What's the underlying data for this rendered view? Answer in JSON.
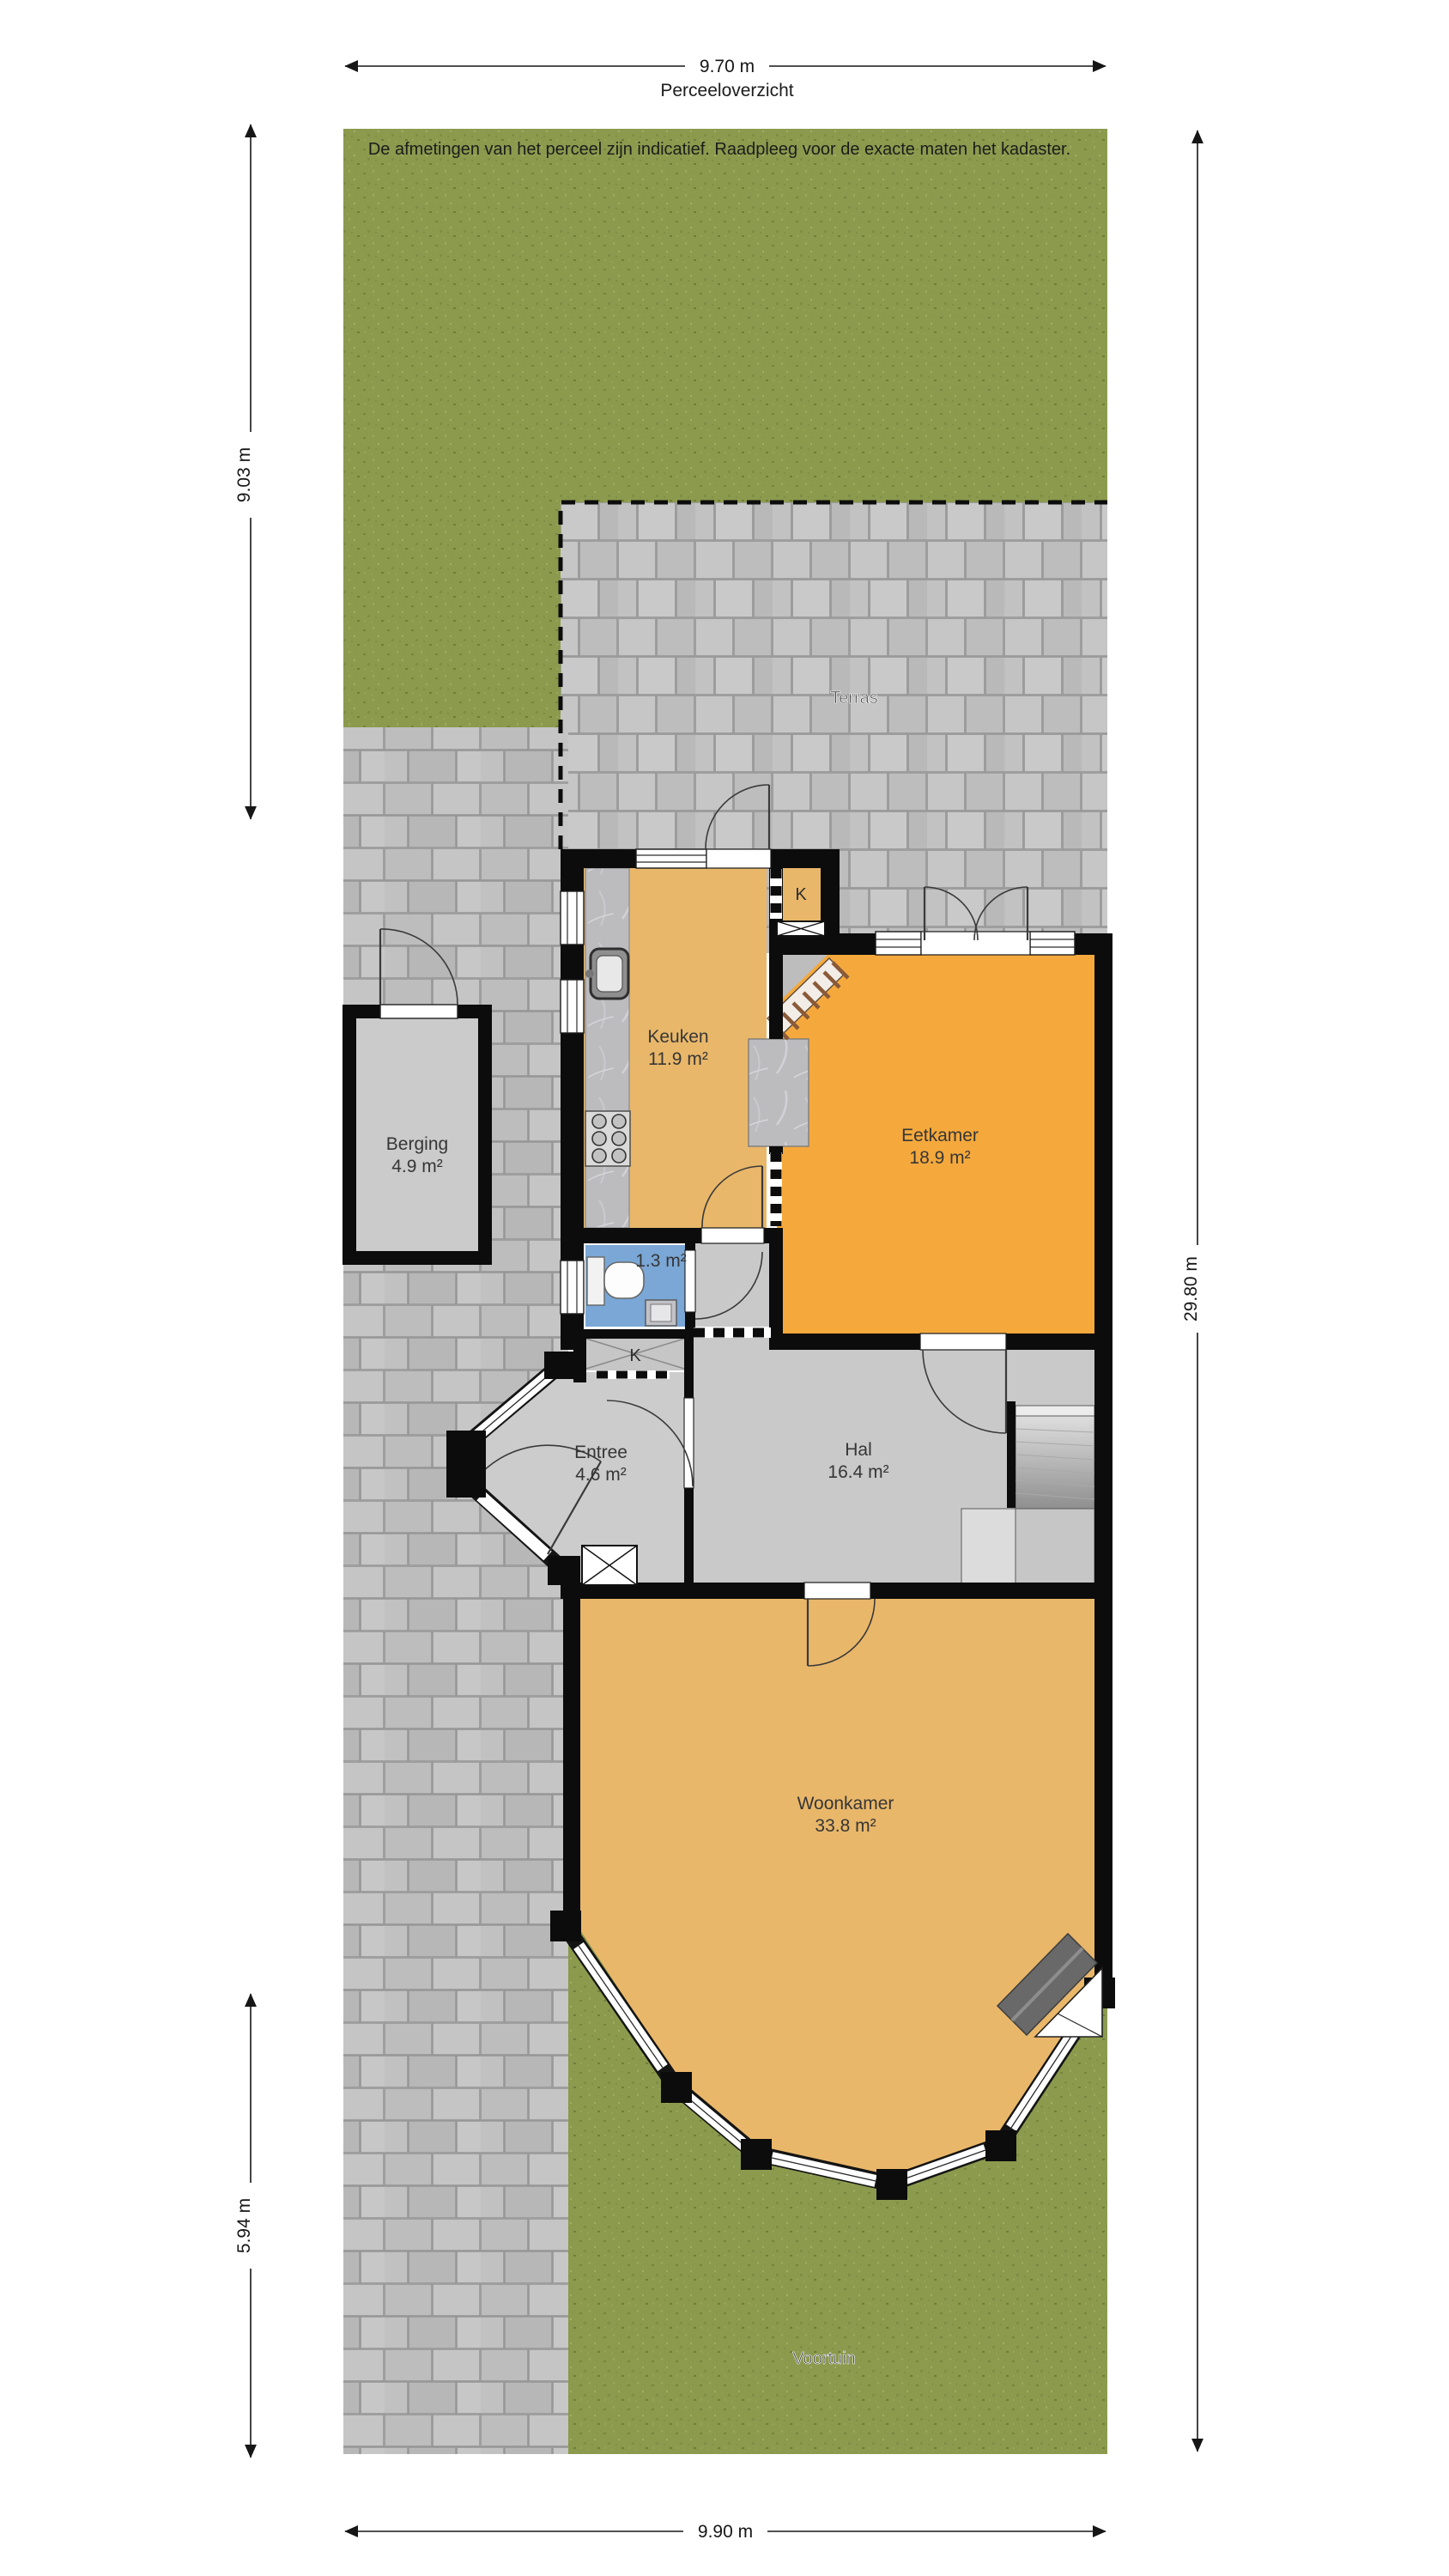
{
  "page": {
    "title": "Perceeloverzicht",
    "disclaimer": "De afmetingen van het perceel zijn indicatief. Raadpleeg voor de exacte maten het kadaster."
  },
  "dimensions": {
    "top": "9.70 m",
    "left_upper": "9.03 m",
    "left_lower": "5.94 m",
    "right": "29.80 m",
    "bottom": "9.90 m"
  },
  "site": {
    "terrace_label": "Terras",
    "front_garden_label": "Voortuin"
  },
  "rooms": {
    "berging": {
      "name": "Berging",
      "area": "4.9 m²"
    },
    "keuken": {
      "name": "Keuken",
      "area": "11.9 m²"
    },
    "eetkamer": {
      "name": "Eetkamer",
      "area": "18.9 m²"
    },
    "toilet": {
      "area": "1.3 m²"
    },
    "closet_upper": {
      "label": "K"
    },
    "closet_lower": {
      "label": "K"
    },
    "entree": {
      "name": "Entree",
      "area": "4.6 m²"
    },
    "hal": {
      "name": "Hal",
      "area": "16.4 m²"
    },
    "woonkamer": {
      "name": "Woonkamer",
      "area": "33.8 m²"
    }
  },
  "colors": {
    "wall": "#0c0c0c",
    "floor_tan": "#e9b76a",
    "floor_orange": "#f5a93c",
    "floor_grey": "#c9c9c9",
    "toilet_blue": "#7aa7d6",
    "grass": "#8b9a4d",
    "paving": "#bfbfbf",
    "terrace": "#c4c4c4"
  }
}
